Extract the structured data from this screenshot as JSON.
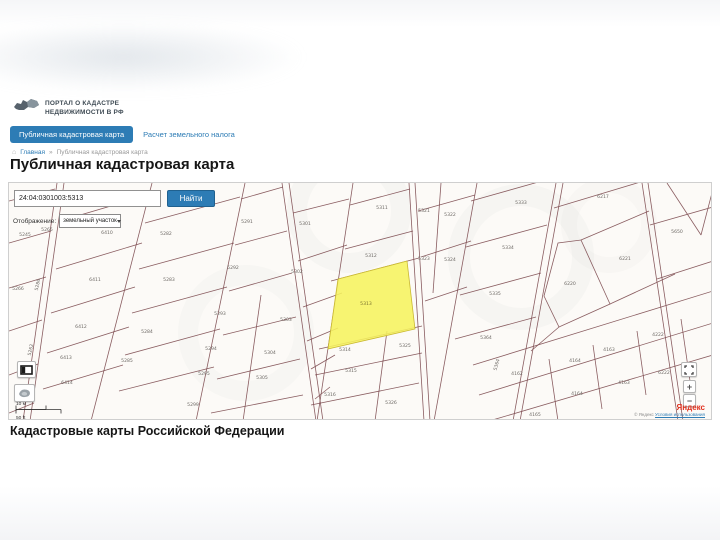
{
  "header": {
    "logo": {
      "line1": "ПОРТАЛ О КАДАСТРЕ",
      "line2": "НЕДВИЖИМОСТИ В РФ"
    },
    "tabs": [
      {
        "label": "Публичная кадастровая карта",
        "active": true
      },
      {
        "label": "Расчет земельного налога",
        "active": false
      }
    ],
    "breadcrumb": {
      "home_icon": "home-icon",
      "home": "Главная",
      "separator": "»",
      "current": "Публичная кадастровая карта"
    },
    "page_title": "Публичная кадастровая карта"
  },
  "search": {
    "query": "24:04:0301003:5313",
    "find_button": "Найти",
    "display_label": "Отображение:",
    "display_value": "земельный участок"
  },
  "map": {
    "highlighted_parcel": "5313",
    "highlight_color": "#f6f35e",
    "line_color": "#7d4b50",
    "scale": {
      "metric": "10 м",
      "imperial": "50 ft"
    },
    "controls": {
      "zoom_in": "+",
      "zoom_out": "−"
    },
    "attribution": {
      "brand": "Яндекс",
      "copyright": "© Яндекс",
      "terms": "Условия использования"
    },
    "parcel_labels": [
      {
        "t": "5245",
        "x": 16,
        "y": 53
      },
      {
        "t": "5265",
        "x": 38,
        "y": 48
      },
      {
        "t": "5266",
        "x": 9,
        "y": 107
      },
      {
        "t": "5286",
        "x": 30,
        "y": 102,
        "r": -78
      },
      {
        "t": "5262",
        "x": 23,
        "y": 167,
        "r": -78
      },
      {
        "t": "6410",
        "x": 98,
        "y": 51
      },
      {
        "t": "6411",
        "x": 86,
        "y": 98
      },
      {
        "t": "6412",
        "x": 72,
        "y": 145
      },
      {
        "t": "6413",
        "x": 57,
        "y": 176
      },
      {
        "t": "6414",
        "x": 58,
        "y": 201
      },
      {
        "t": "5282",
        "x": 157,
        "y": 52
      },
      {
        "t": "5283",
        "x": 160,
        "y": 98
      },
      {
        "t": "5284",
        "x": 138,
        "y": 150
      },
      {
        "t": "5285",
        "x": 118,
        "y": 179
      },
      {
        "t": "5291",
        "x": 238,
        "y": 40
      },
      {
        "t": "5292",
        "x": 224,
        "y": 86
      },
      {
        "t": "5293",
        "x": 211,
        "y": 132
      },
      {
        "t": "5294",
        "x": 202,
        "y": 167
      },
      {
        "t": "5295",
        "x": 195,
        "y": 192
      },
      {
        "t": "5299",
        "x": 184,
        "y": 223
      },
      {
        "t": "5301",
        "x": 296,
        "y": 42
      },
      {
        "t": "5302",
        "x": 288,
        "y": 90
      },
      {
        "t": "5303",
        "x": 277,
        "y": 138
      },
      {
        "t": "5304",
        "x": 261,
        "y": 171
      },
      {
        "t": "5305",
        "x": 253,
        "y": 196
      },
      {
        "t": "5311",
        "x": 373,
        "y": 26
      },
      {
        "t": "5312",
        "x": 362,
        "y": 74
      },
      {
        "t": "5313",
        "x": 357,
        "y": 122,
        "hl": true
      },
      {
        "t": "5314",
        "x": 336,
        "y": 168
      },
      {
        "t": "5315",
        "x": 342,
        "y": 189
      },
      {
        "t": "5316",
        "x": 321,
        "y": 213
      },
      {
        "t": "5325",
        "x": 396,
        "y": 164
      },
      {
        "t": "5326",
        "x": 382,
        "y": 221
      },
      {
        "t": "5321",
        "x": 415,
        "y": 29
      },
      {
        "t": "5322",
        "x": 441,
        "y": 33
      },
      {
        "t": "5323",
        "x": 415,
        "y": 77
      },
      {
        "t": "5324",
        "x": 441,
        "y": 78
      },
      {
        "t": "5333",
        "x": 512,
        "y": 21
      },
      {
        "t": "5334",
        "x": 499,
        "y": 66
      },
      {
        "t": "5335",
        "x": 486,
        "y": 112
      },
      {
        "t": "5364",
        "x": 477,
        "y": 156
      },
      {
        "t": "5364",
        "x": 489,
        "y": 182,
        "r": -75
      },
      {
        "t": "6217",
        "x": 594,
        "y": 15
      },
      {
        "t": "6221",
        "x": 616,
        "y": 77
      },
      {
        "t": "6220",
        "x": 561,
        "y": 102
      },
      {
        "t": "4162",
        "x": 508,
        "y": 192
      },
      {
        "t": "4164",
        "x": 566,
        "y": 179
      },
      {
        "t": "4163",
        "x": 600,
        "y": 168
      },
      {
        "t": "4222",
        "x": 649,
        "y": 153
      },
      {
        "t": "4165",
        "x": 526,
        "y": 233
      },
      {
        "t": "4164",
        "x": 568,
        "y": 212
      },
      {
        "t": "4163",
        "x": 615,
        "y": 201
      },
      {
        "t": "6222",
        "x": 655,
        "y": 191
      },
      {
        "t": "5650",
        "x": 668,
        "y": 50
      }
    ]
  },
  "footer": {
    "caption": "Кадастровые карты Российской Федерации"
  }
}
